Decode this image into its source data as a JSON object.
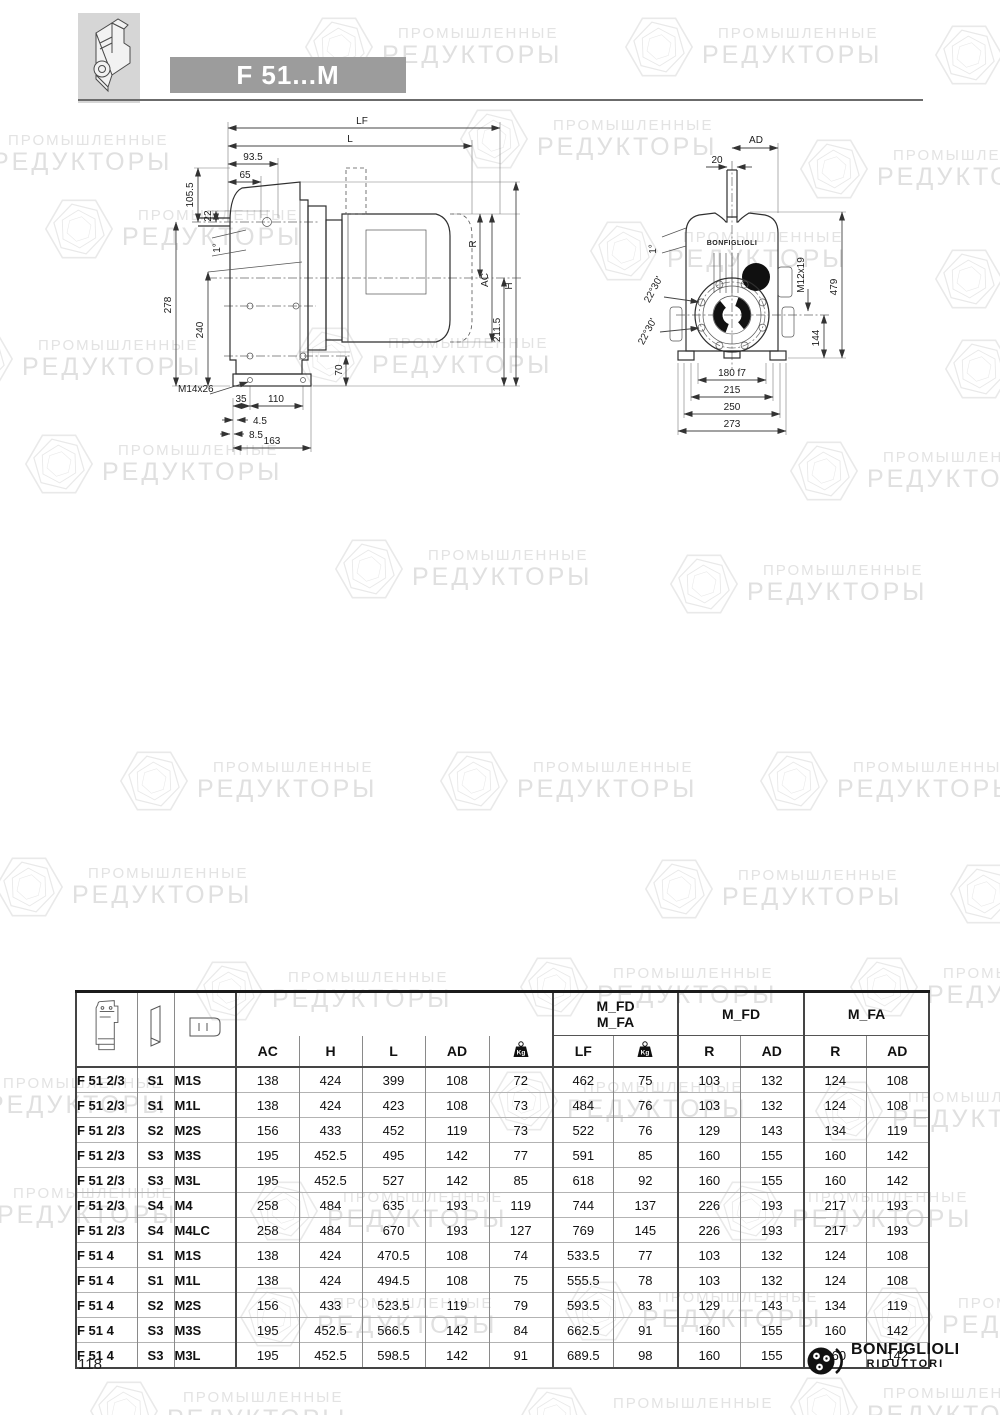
{
  "header": {
    "title": "F 51...M"
  },
  "watermark": {
    "line1": "ПРОМЫШЛЕННЫЕ",
    "line2": "РЕДУКТОРЫ"
  },
  "drawing_side": {
    "dims": {
      "lf": "LF",
      "l": "L",
      "d93_5": "93.5",
      "d65": "65",
      "d22": "22",
      "d105_5": "105.5",
      "angle": "1°",
      "d278": "278",
      "d240": "240",
      "r": "R",
      "ac": "AC",
      "d211_5": "211.5",
      "h": "H",
      "d70": "70",
      "m14": "M14x26",
      "d35": "35",
      "d110": "110",
      "d4_5": "4.5",
      "d8_5": "8.5",
      "d163": "163"
    }
  },
  "drawing_front": {
    "brand": "BONFIGLIOLI",
    "dims": {
      "ad": "AD",
      "d20": "20",
      "angle": "1°",
      "m12": "M12x19",
      "d479": "479",
      "a2230a": "22°30'",
      "a2230b": "22°30'",
      "d144": "144",
      "d180": "180 f7",
      "d215": "215",
      "d250": "250",
      "d273": "273"
    }
  },
  "table": {
    "groups": {
      "mfd_mfa_line1": "M_FD",
      "mfd_mfa_line2": "M_FA",
      "mfd": "M_FD",
      "mfa": "M_FA"
    },
    "columns": {
      "ac": "AC",
      "h": "H",
      "l": "L",
      "ad": "AD",
      "kg": "Kg",
      "lf": "LF",
      "r": "R"
    },
    "rows": [
      [
        "F 51 2/3",
        "S1",
        "M1S",
        "138",
        "424",
        "399",
        "108",
        "72",
        "462",
        "75",
        "103",
        "132",
        "124",
        "108"
      ],
      [
        "F 51 2/3",
        "S1",
        "M1L",
        "138",
        "424",
        "423",
        "108",
        "73",
        "484",
        "76",
        "103",
        "132",
        "124",
        "108"
      ],
      [
        "F 51 2/3",
        "S2",
        "M2S",
        "156",
        "433",
        "452",
        "119",
        "73",
        "522",
        "76",
        "129",
        "143",
        "134",
        "119"
      ],
      [
        "F 51 2/3",
        "S3",
        "M3S",
        "195",
        "452.5",
        "495",
        "142",
        "77",
        "591",
        "85",
        "160",
        "155",
        "160",
        "142"
      ],
      [
        "F 51 2/3",
        "S3",
        "M3L",
        "195",
        "452.5",
        "527",
        "142",
        "85",
        "618",
        "92",
        "160",
        "155",
        "160",
        "142"
      ],
      [
        "F 51 2/3",
        "S4",
        "M4",
        "258",
        "484",
        "635",
        "193",
        "119",
        "744",
        "137",
        "226",
        "193",
        "217",
        "193"
      ],
      [
        "F 51 2/3",
        "S4",
        "M4LC",
        "258",
        "484",
        "670",
        "193",
        "127",
        "769",
        "145",
        "226",
        "193",
        "217",
        "193"
      ],
      [
        "F 51 4",
        "S1",
        "M1S",
        "138",
        "424",
        "470.5",
        "108",
        "74",
        "533.5",
        "77",
        "103",
        "132",
        "124",
        "108"
      ],
      [
        "F 51 4",
        "S1",
        "M1L",
        "138",
        "424",
        "494.5",
        "108",
        "75",
        "555.5",
        "78",
        "103",
        "132",
        "124",
        "108"
      ],
      [
        "F 51 4",
        "S2",
        "M2S",
        "156",
        "433",
        "523.5",
        "119",
        "79",
        "593.5",
        "83",
        "129",
        "143",
        "134",
        "119"
      ],
      [
        "F 51 4",
        "S3",
        "M3S",
        "195",
        "452.5",
        "566.5",
        "142",
        "84",
        "662.5",
        "91",
        "160",
        "155",
        "160",
        "142"
      ],
      [
        "F 51 4",
        "S3",
        "M3L",
        "195",
        "452.5",
        "598.5",
        "142",
        "91",
        "689.5",
        "98",
        "160",
        "155",
        "160",
        "142"
      ]
    ]
  },
  "footer": {
    "page_number": "118",
    "logo_name": "BONFIGLIOLI",
    "logo_sub": "RIDUTTORI"
  }
}
